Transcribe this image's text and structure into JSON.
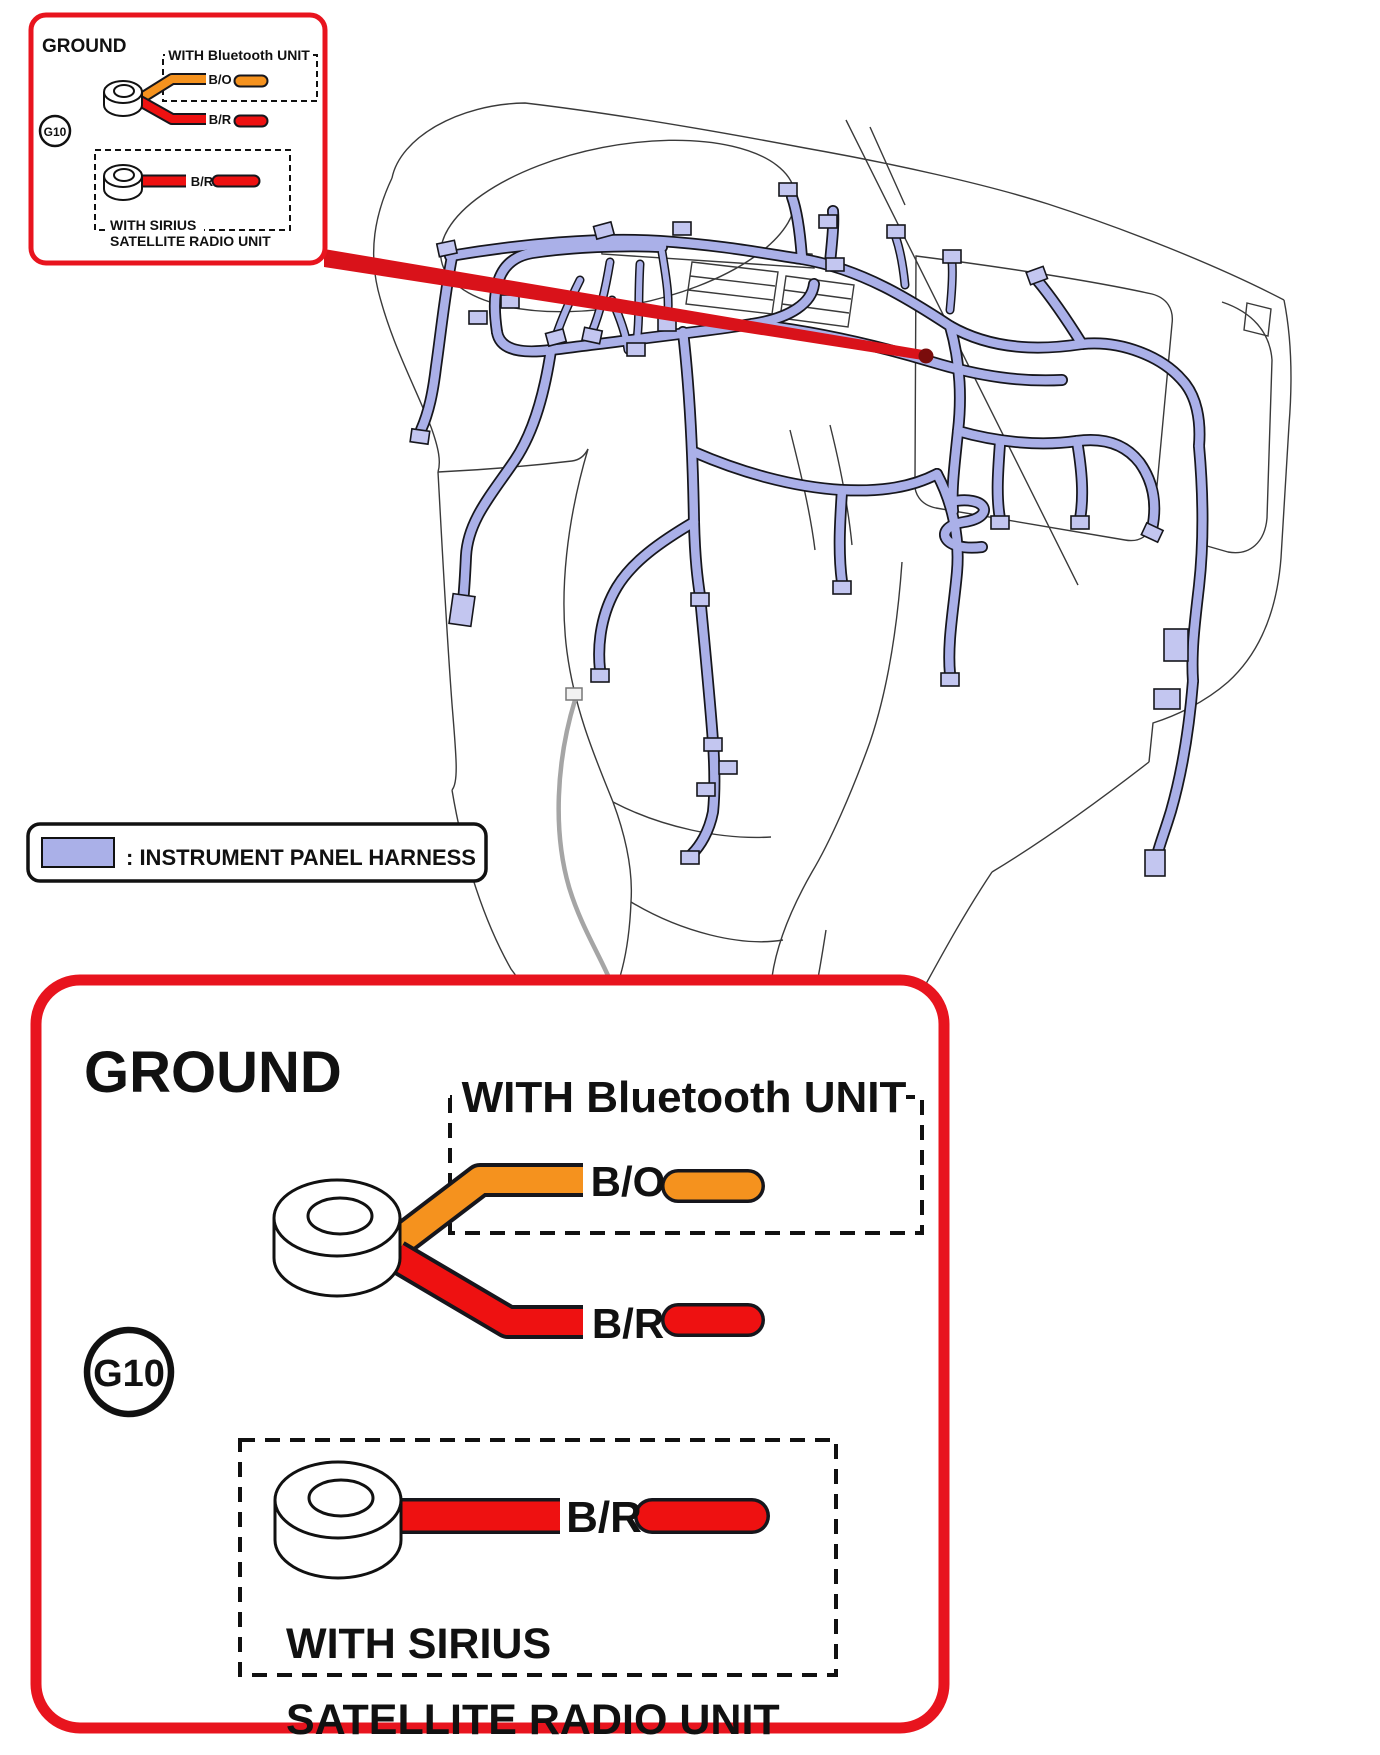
{
  "callout": {
    "title": "GROUND",
    "ground_id": "G10",
    "bluetooth": {
      "label": "WITH Bluetooth UNIT",
      "wire": "B/O"
    },
    "ground_wire": "B/R",
    "sirius": {
      "wire": "B/R",
      "label_line1": "WITH SIRIUS",
      "label_line2": "SATELLITE RADIO UNIT"
    }
  },
  "legend": {
    "label": ": INSTRUMENT PANEL HARNESS"
  },
  "colors": {
    "callout_border": "#e8141e",
    "leader": "#d9121a",
    "leader_tip": "#7a0c0c",
    "harness": "#aab0e8",
    "connector_fill": "#c3c6f0",
    "wire_orange": "#f5921e",
    "wire_red": "#ee1111",
    "outline": "#3a3a3a",
    "legend_swatch": "#aab0e8"
  }
}
